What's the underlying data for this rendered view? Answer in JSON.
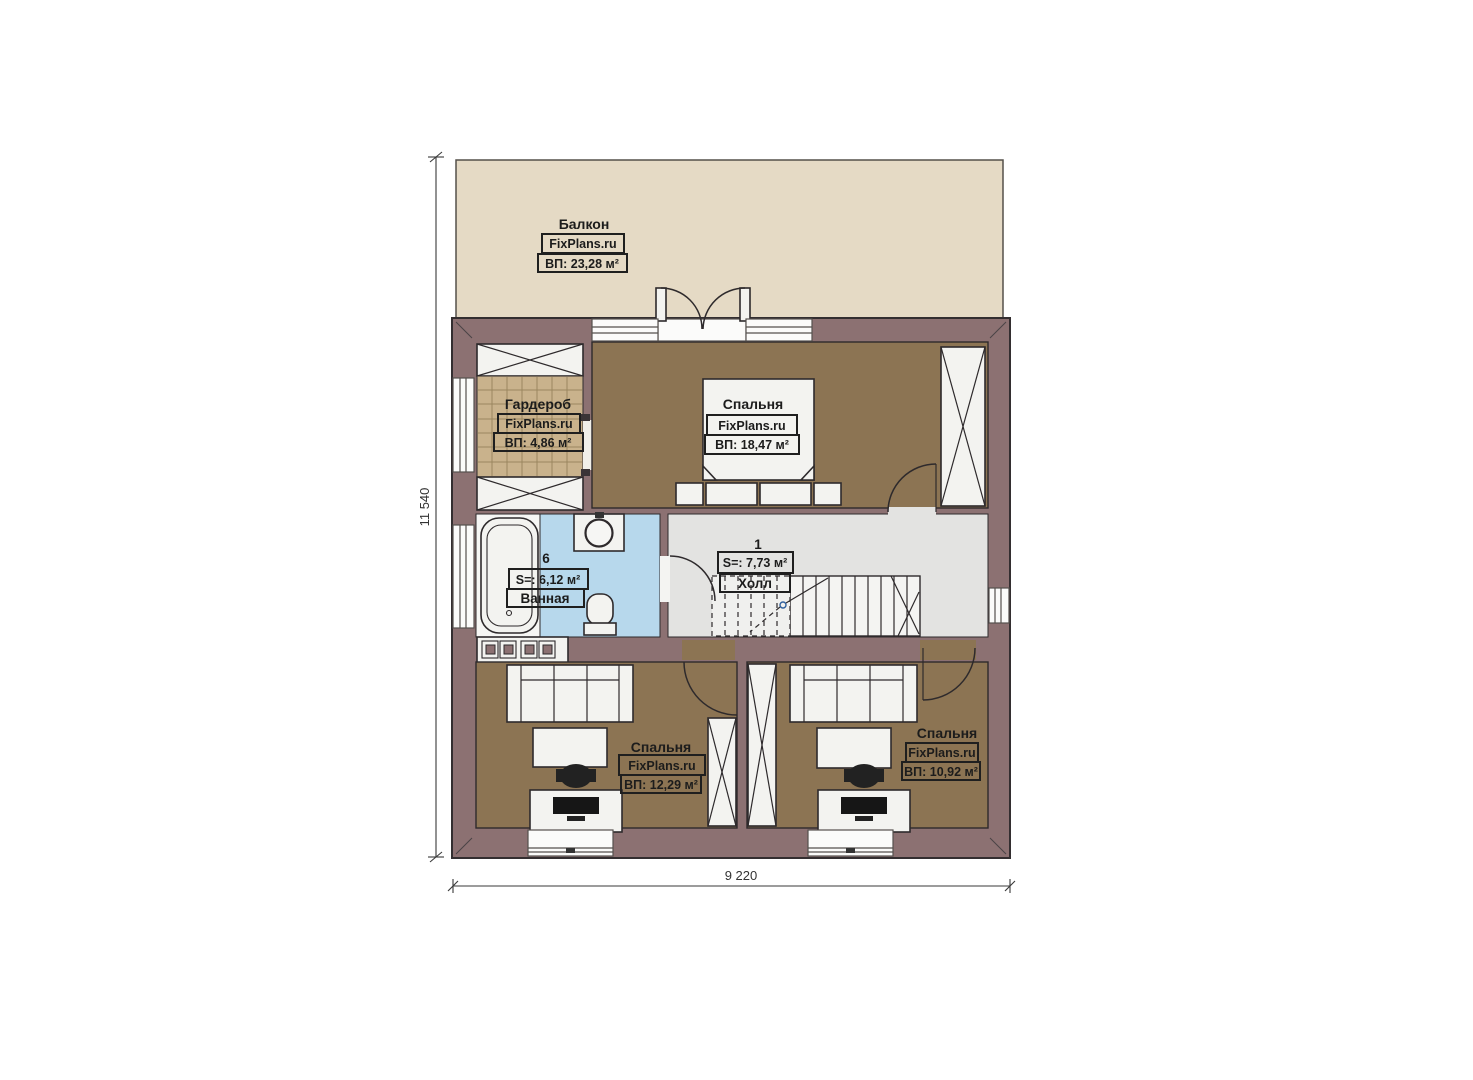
{
  "dimensions": {
    "height": "11 540",
    "width": "9 220"
  },
  "rooms": {
    "balcony": {
      "name": "Балкон",
      "brand": "FixPlans.ru",
      "area": "ВП: 23,28 м²"
    },
    "wardrobe": {
      "name": "Гардероб",
      "brand": "FixPlans.ru",
      "area": "ВП: 4,86 м²"
    },
    "bedroom_top": {
      "name": "Спальня",
      "brand": "FixPlans.ru",
      "area": "ВП: 18,47 м²"
    },
    "bathroom": {
      "number": "6",
      "area": "S=: 6,12 м²",
      "name": "Ванная"
    },
    "hall": {
      "number": "1",
      "area": "S=: 7,73 м²",
      "name": "Холл"
    },
    "bedroom_left": {
      "name": "Спальня",
      "brand": "FixPlans.ru",
      "area": "ВП: 12,29 м²"
    },
    "bedroom_right": {
      "name": "Спальня",
      "brand": "FixPlans.ru",
      "area": "ВП: 10,92 м²"
    }
  },
  "colors": {
    "wall": "#8c7172",
    "balcony_floor": "#e5dac5",
    "bedroom_floor": "#8c7453",
    "wardrobe_floor": "#c9b28c",
    "bathroom_floor": "#b7d8ec",
    "hall_floor": "#e3e3e1"
  }
}
